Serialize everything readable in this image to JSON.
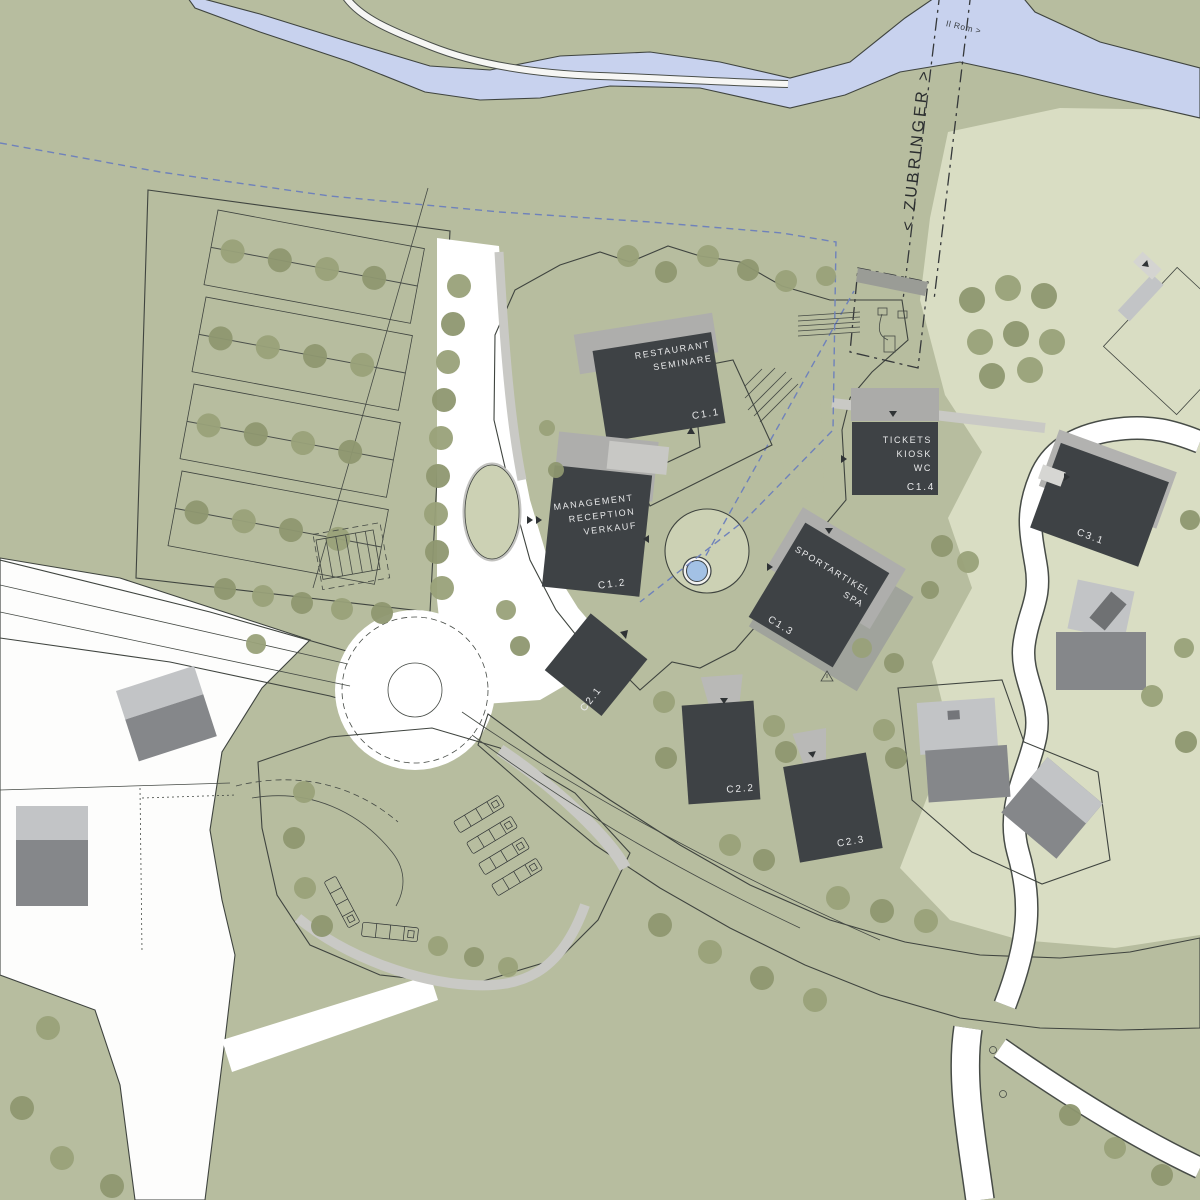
{
  "palette": {
    "green_base": "#b7bd9f",
    "green_light": "#d9ddc3",
    "green_circle": "#ccd1b4",
    "tree": "#99a179",
    "tree_dark": "#8e9770",
    "white": "#ffffff",
    "plaza": "#ebebe8",
    "road_gray": "#c9c9c5",
    "pad_gray": "#dadad7",
    "building_dark": "#3e4245",
    "building_mid": "#85878a",
    "building_light": "#c2c4c6",
    "canopy": "#aeaeac",
    "outline": "#3f443f",
    "river": "#c8d2ee",
    "blue": "#6f82bb",
    "fountain": "#a3c1e5",
    "label": "#e8e9ea",
    "text_dark": "#2f3335"
  },
  "buildings": {
    "c1_1": {
      "code": "C1.1",
      "lines": [
        "RESTAURANT",
        "SEMINARE"
      ]
    },
    "c1_2": {
      "code": "C1.2",
      "lines": [
        "MANAGEMENT",
        "RECEPTION",
        "VERKAUF"
      ]
    },
    "c1_3": {
      "code": "C1.3",
      "lines": [
        "SPORTARTIKEL",
        "SPA"
      ]
    },
    "c1_4": {
      "code": "C1.4",
      "lines": [
        "TICKETS",
        "KIOSK",
        "WC"
      ]
    },
    "c2_1": {
      "code": "C2.1"
    },
    "c2_2": {
      "code": "C2.2"
    },
    "c2_3": {
      "code": "C2.3"
    },
    "c3_1": {
      "code": "C3.1"
    }
  },
  "annotations": {
    "feeder_road": "< ZUBRINGER >",
    "river": "Il Rom >"
  }
}
